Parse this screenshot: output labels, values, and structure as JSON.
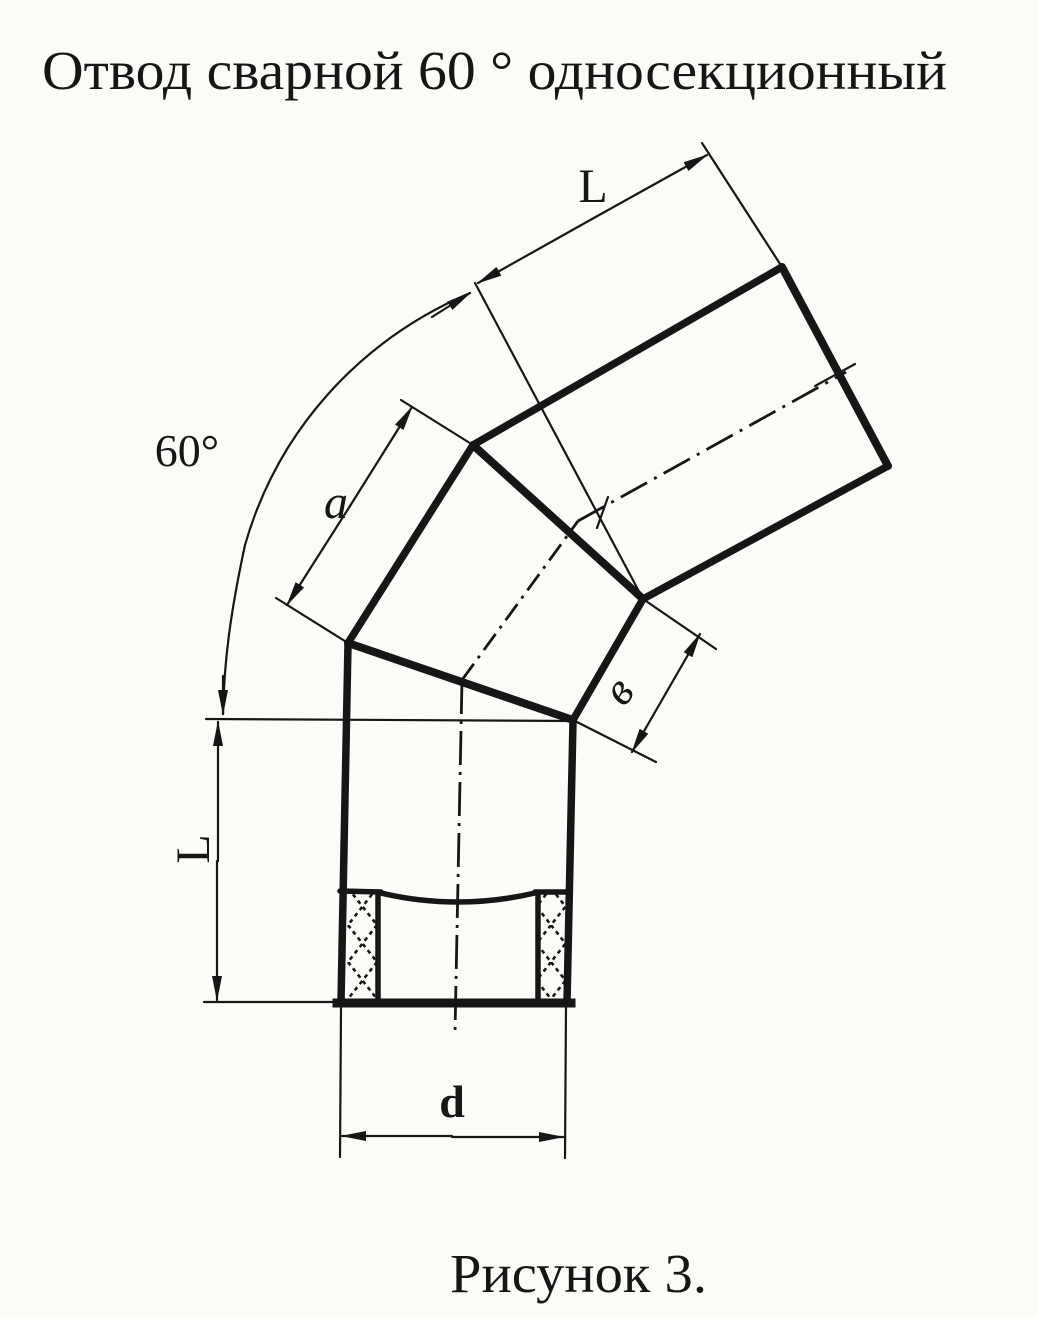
{
  "title": "Отвод сварной 60 ° односекционный",
  "caption": "Рисунок 3.",
  "labels": {
    "top_length": "L",
    "angle": "60°",
    "section_outer": "a",
    "section_inner": "в",
    "bottom_length": "L",
    "diameter": "d"
  },
  "colors": {
    "ink": "#161616",
    "paper": "#fbfbf8"
  }
}
